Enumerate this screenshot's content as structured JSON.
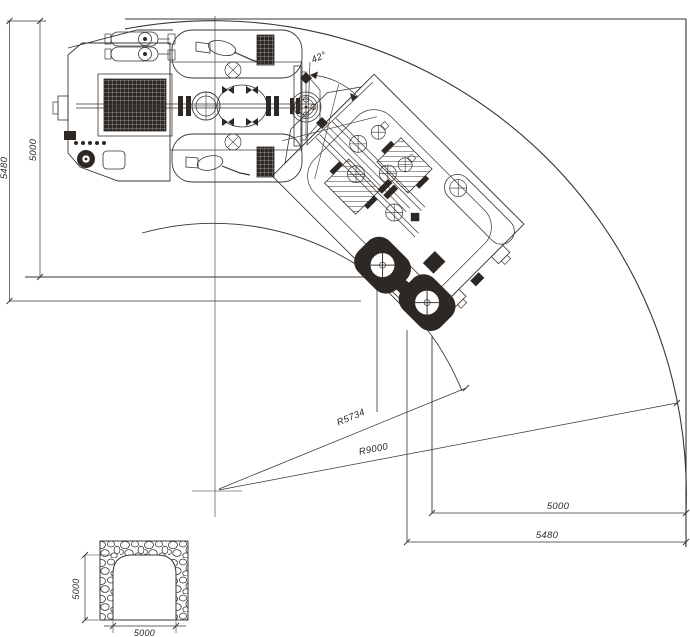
{
  "drawing": {
    "labels": {
      "left_tunnel_width": "5000",
      "left_clearance": "5480",
      "bottom_tunnel_width": "5000",
      "bottom_clearance": "5480",
      "inner_radius": "R5734",
      "outer_radius": "R9000",
      "articulation_angle": "42°"
    },
    "cross_section": {
      "height": "5000",
      "width": "5000"
    },
    "colors": {
      "line": "#3a3531",
      "dark_fill": "#2e2825",
      "background": "#ffffff"
    }
  }
}
